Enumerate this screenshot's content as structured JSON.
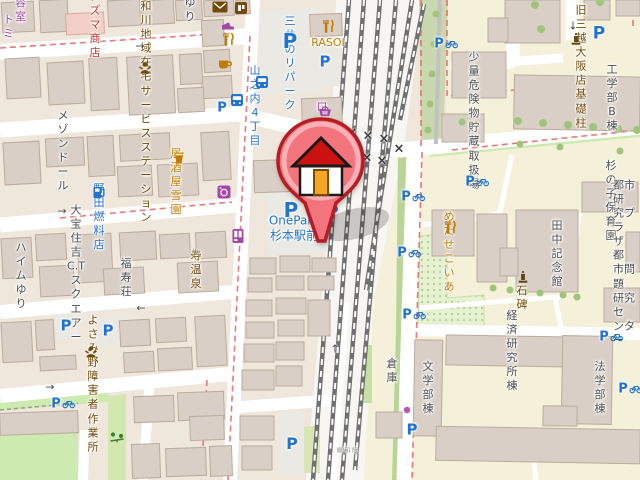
{
  "map": {
    "style": "openstreetmap-carto-ja",
    "marker": {
      "name": "home-location-marker",
      "description": "red pin with house"
    },
    "colors": {
      "road": "#ffffff",
      "land_residential": "#efe6dc",
      "campus": "#f4f0da",
      "building": "#d9cfc6",
      "building_outline": "#bbab9c",
      "grass": "#cdebb0",
      "parking_lot": "#ebe9e4",
      "parking_blue": "#2273d0",
      "amenity_brown": "#734a08",
      "food_amber": "#bf7c00",
      "shop_purple": "#a449a7",
      "label_gray": "#4d4d4d",
      "boundary_red": "#e86a6a",
      "rail_gray": "#707070",
      "name_red": "#c7342e"
    },
    "labels": [
      {
        "name": "biyoshitsu-partial",
        "text": "容室",
        "x": 15,
        "y": 10,
        "color": "#a449a7",
        "size": 11,
        "align": "left"
      },
      {
        "name": "tomi-partial",
        "text": "トミ",
        "x": 3,
        "y": 27,
        "color": "#a449a7",
        "size": 11,
        "align": "left"
      },
      {
        "name": "azuma-shoten",
        "text": "アズマ商\n店",
        "x": 95,
        "y": 25,
        "color": "#c7342e",
        "size": 11
      },
      {
        "name": "yuri",
        "text": "ゆり",
        "x": 190,
        "y": 10,
        "color": "#4d4d4d",
        "size": 11
      },
      {
        "name": "yamatogawa-service-station",
        "text": "大和川地\n域在宅サー\nビスステー\nション",
        "x": 146,
        "y": 105,
        "color": "#734a08",
        "size": 11
      },
      {
        "name": "maison-dor",
        "text": "メゾン\nドール",
        "x": 63,
        "y": 151,
        "color": "#4d4d4d",
        "size": 11
      },
      {
        "name": "izakaya-yukizono",
        "text": "居酒屋\n雪園",
        "x": 176,
        "y": 182,
        "color": "#bf7c00",
        "size": 11
      },
      {
        "name": "noda-nenryoten",
        "text": "野田燃料\n店",
        "x": 99,
        "y": 217,
        "color": "#2273d0",
        "size": 11
      },
      {
        "name": "heim-yuri",
        "text": "ハイム\nゆり",
        "x": 21,
        "y": 276,
        "color": "#4d4d4d",
        "size": 11
      },
      {
        "name": "taiho-sumiyoshi-ct-square",
        "text": "大宝住\n吉C.T\nスクエ\nアー",
        "x": 76,
        "y": 274,
        "color": "#4d4d4d",
        "size": 11
      },
      {
        "name": "fukujuso",
        "text": "福寿荘",
        "x": 126,
        "y": 278,
        "color": "#4d4d4d",
        "size": 11
      },
      {
        "name": "kotobuki-onsen",
        "text": "寿温泉",
        "x": 196,
        "y": 270,
        "color": "#734a08",
        "size": 11
      },
      {
        "name": "yosamino-sagyosho",
        "text": "よさみ野\n障害者作\n業所",
        "x": 93,
        "y": 384,
        "color": "#734a08",
        "size": 11
      },
      {
        "name": "onepark-sugimoto-ekimae",
        "text": "OnePark\n杉本駅前",
        "x": 294,
        "y": 229,
        "color": "#2273d0",
        "size": 12
      },
      {
        "name": "lawson",
        "text": "ローソン",
        "x": 322,
        "y": 128,
        "color": "#a449a7",
        "size": 11
      },
      {
        "name": "mitsui-no-repark",
        "text": "三井のリ\nパーク",
        "x": 290,
        "y": 64,
        "color": "#2273d0",
        "size": 11
      },
      {
        "name": "rasoi",
        "text": "RASOI",
        "x": 328,
        "y": 43,
        "color": "#bf7c00",
        "size": 11
      },
      {
        "name": "yamanouchi-4-chome",
        "text": "山之内4\n丁目",
        "x": 255,
        "y": 106,
        "color": "#2273d0",
        "size": 11
      },
      {
        "name": "kyu-mitsukoshi-kiso-hashira",
        "text": "旧三越大\n阪店基礎\n柱",
        "x": 581,
        "y": 67,
        "color": "#734a08",
        "size": 11
      },
      {
        "name": "kogakubu-b-to",
        "text": "工学部\nB棟",
        "x": 612,
        "y": 98,
        "color": "#4d4d4d",
        "size": 11
      },
      {
        "name": "shoryo-kikenbutsu",
        "text": "少量危\n険物貯\n蔵取扱\n場",
        "x": 474,
        "y": 121,
        "color": "#4d4d4d",
        "size": 11
      },
      {
        "name": "metasequoia",
        "text": "めたせこ\nいあ",
        "x": 449,
        "y": 252,
        "color": "#bf7c00",
        "size": 11
      },
      {
        "name": "tanaka-kinenkan",
        "text": "田中記\n念館",
        "x": 557,
        "y": 254,
        "color": "#4d4d4d",
        "size": 11
      },
      {
        "name": "sekihi",
        "text": "石碑",
        "x": 522,
        "y": 298,
        "color": "#734a08",
        "size": 11
      },
      {
        "name": "suginoko-hoikuen",
        "text": "杉の子\n保育園",
        "x": 611,
        "y": 201,
        "color": "#4d4d4d",
        "size": 11
      },
      {
        "name": "toshi-kenkyu-plaza",
        "text": "都市研\n究プラ\nザ　都\n市問題\n研究セ\nンター",
        "x": 613,
        "y": 263,
        "color": "#4d4d4d",
        "size": 11,
        "align": "left"
      },
      {
        "name": "keizai-kenkyusho-to",
        "text": "経済研\n究所棟",
        "x": 512,
        "y": 351,
        "color": "#4d4d4d",
        "size": 11
      },
      {
        "name": "bungakubu-to",
        "text": "文学部\n棟",
        "x": 428,
        "y": 388,
        "color": "#4d4d4d",
        "size": 11
      },
      {
        "name": "hogakubu-to",
        "text": "法学部\n棟",
        "x": 600,
        "y": 388,
        "color": "#4d4d4d",
        "size": 11
      },
      {
        "name": "soko",
        "text": "倉庫",
        "x": 392,
        "y": 371,
        "color": "#4d4d4d",
        "size": 11
      },
      {
        "name": "hanwa-line",
        "text": "阪和線",
        "x": 346,
        "y": 450,
        "color": "#8a8a8a",
        "size": 6,
        "vertical": true
      }
    ],
    "icons": [
      {
        "kind": "envelope",
        "name": "post-office-icon",
        "x": 220,
        "y": 7
      },
      {
        "kind": "shop",
        "name": "convenience-store-icon",
        "x": 241,
        "y": 8
      },
      {
        "kind": "shoes",
        "name": "shoe-shop-icon",
        "x": 228,
        "y": 26
      },
      {
        "kind": "cutlery",
        "name": "restaurant-icon",
        "x": 228,
        "y": 39
      },
      {
        "kind": "cup",
        "name": "cafe-icon",
        "x": 225,
        "y": 64
      },
      {
        "kind": "cutlery",
        "name": "rasoi-restaurant-icon",
        "x": 328,
        "y": 26
      },
      {
        "kind": "parking",
        "char": "P",
        "name": "mitsui-repark-parking-icon",
        "x": 290,
        "y": 41,
        "size": 20
      },
      {
        "kind": "parking",
        "char": "P",
        "name": "rasoi-parking-icon",
        "x": 325,
        "y": 62,
        "size": 15
      },
      {
        "kind": "bus",
        "name": "bus-stop-icon",
        "x": 262,
        "y": 82
      },
      {
        "kind": "bus",
        "name": "bus-stop-icon",
        "x": 237,
        "y": 100
      },
      {
        "kind": "parking",
        "char": "P",
        "name": "parking-icon",
        "x": 222,
        "y": 108,
        "size": 13
      },
      {
        "kind": "basket",
        "name": "supermarket-basket-icon",
        "x": 325,
        "y": 111
      },
      {
        "kind": "person",
        "name": "social-facility-icon",
        "x": 145,
        "y": 68
      },
      {
        "kind": "beer",
        "name": "izakaya-icon",
        "x": 179,
        "y": 158
      },
      {
        "kind": "laundry",
        "name": "laundry-icon",
        "x": 224,
        "y": 192
      },
      {
        "kind": "vending",
        "name": "vending-machine-icon",
        "x": 238,
        "y": 236
      },
      {
        "kind": "fuel",
        "name": "fuel-station-icon",
        "x": 99,
        "y": 192
      },
      {
        "kind": "onsen",
        "name": "onsen-icon",
        "x": 196,
        "y": 253
      },
      {
        "kind": "person",
        "name": "social-facility-icon",
        "x": 91,
        "y": 352
      },
      {
        "kind": "parking",
        "char": "P",
        "name": "onepark-parking-icon",
        "x": 291,
        "y": 210,
        "size": 20
      },
      {
        "kind": "parking",
        "char": "P",
        "name": "parking-icon",
        "x": 333,
        "y": 212,
        "size": 15
      },
      {
        "kind": "parking",
        "char": "P",
        "name": "parking-icon",
        "x": 66,
        "y": 326,
        "size": 15
      },
      {
        "kind": "parking",
        "char": "P",
        "name": "parking-icon",
        "x": 108,
        "y": 331,
        "size": 15
      },
      {
        "kind": "parking-bike",
        "char": "P",
        "name": "bicycle-parking-icon",
        "x": 63,
        "y": 404
      },
      {
        "kind": "parking",
        "char": "P",
        "name": "parking-icon",
        "x": 292,
        "y": 444,
        "size": 16
      },
      {
        "kind": "playground",
        "name": "playground-icon",
        "x": 117,
        "y": 437
      },
      {
        "kind": "parking-bike",
        "char": "P",
        "name": "bicycle-parking-icon",
        "x": 446,
        "y": 44
      },
      {
        "kind": "parking-bike",
        "char": "P",
        "name": "bicycle-parking-icon",
        "x": 477,
        "y": 182
      },
      {
        "kind": "parking-bike",
        "char": "P",
        "name": "bicycle-parking-icon",
        "x": 413,
        "y": 197
      },
      {
        "kind": "parking-bike",
        "char": "P",
        "name": "bicycle-parking-icon",
        "x": 409,
        "y": 253
      },
      {
        "kind": "parking-bike",
        "char": "P",
        "name": "bicycle-parking-icon",
        "x": 414,
        "y": 315
      },
      {
        "kind": "parking-bike",
        "char": "P",
        "name": "bicycle-parking-icon",
        "x": 611,
        "y": 337
      },
      {
        "kind": "parking-bike",
        "char": "P",
        "name": "bicycle-parking-icon",
        "x": 630,
        "y": 389
      },
      {
        "kind": "parking",
        "char": "P",
        "name": "parking-icon",
        "x": 412,
        "y": 430,
        "size": 15
      },
      {
        "kind": "parking",
        "char": "P",
        "name": "parking-icon",
        "x": 599,
        "y": 34,
        "size": 17
      },
      {
        "kind": "monument",
        "name": "monument-icon",
        "x": 576,
        "y": 39
      },
      {
        "kind": "monument",
        "name": "stone-monument-icon",
        "x": 523,
        "y": 277
      },
      {
        "kind": "cutlery",
        "name": "metasequoia-restaurant-icon",
        "x": 450,
        "y": 227
      },
      {
        "kind": "dot",
        "name": "poi-dot-icon",
        "x": 407,
        "y": 410
      },
      {
        "kind": "glyph",
        "char": "→",
        "name": "oneway-arrow-icon",
        "x": 140,
        "y": 46,
        "size": 11,
        "color": "#4a4a4a"
      },
      {
        "kind": "glyph",
        "char": "→",
        "name": "oneway-arrow-icon",
        "x": 62,
        "y": 211,
        "size": 11,
        "color": "#4a4a4a"
      },
      {
        "kind": "glyph",
        "char": "←",
        "name": "oneway-arrow-icon",
        "x": 141,
        "y": 308,
        "size": 11,
        "color": "#4a4a4a"
      },
      {
        "kind": "glyph",
        "char": "→",
        "name": "oneway-arrow-icon",
        "x": 50,
        "y": 387,
        "size": 11,
        "color": "#4a4a4a"
      },
      {
        "kind": "glyph",
        "char": "↑",
        "name": "oneway-arrow-icon",
        "x": 335,
        "y": 349,
        "size": 11,
        "color": "#4a4a4a"
      },
      {
        "kind": "glyph",
        "char": "↓",
        "name": "oneway-arrow-icon",
        "x": 573,
        "y": 26,
        "size": 11,
        "color": "#4a4a4a"
      },
      {
        "kind": "glyph",
        "char": "×",
        "name": "level-crossing-icon",
        "x": 352,
        "y": 133,
        "size": 13,
        "color": "#3a3a3a",
        "bold": true
      },
      {
        "kind": "glyph",
        "char": "×",
        "name": "level-crossing-icon",
        "x": 368,
        "y": 136,
        "size": 13,
        "color": "#3a3a3a",
        "bold": true
      },
      {
        "kind": "glyph",
        "char": "×",
        "name": "level-crossing-icon",
        "x": 384,
        "y": 139,
        "size": 13,
        "color": "#3a3a3a",
        "bold": true
      },
      {
        "kind": "glyph",
        "char": "×",
        "name": "level-crossing-icon",
        "x": 352,
        "y": 155,
        "size": 13,
        "color": "#3a3a3a",
        "bold": true
      },
      {
        "kind": "glyph",
        "char": "×",
        "name": "level-crossing-icon",
        "x": 367,
        "y": 158,
        "size": 13,
        "color": "#3a3a3a",
        "bold": true
      },
      {
        "kind": "glyph",
        "char": "×",
        "name": "level-crossing-icon",
        "x": 382,
        "y": 161,
        "size": 13,
        "color": "#3a3a3a",
        "bold": true
      },
      {
        "kind": "glyph",
        "char": "×",
        "name": "level-crossing-icon",
        "x": 399,
        "y": 149,
        "size": 13,
        "color": "#3a3a3a",
        "bold": true
      }
    ]
  }
}
